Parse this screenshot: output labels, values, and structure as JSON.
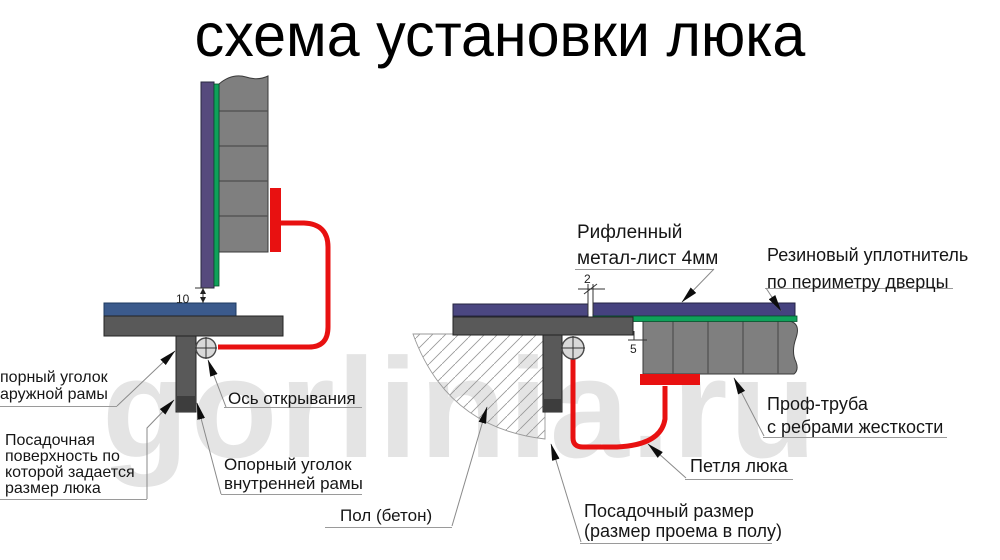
{
  "title": "схема установки люка",
  "watermark": "gorlinia.ru",
  "colors": {
    "hinge_red": "#e81111",
    "sheet_purple_left_view": "#564a7d",
    "sheet_purple_right_view": "#45427f",
    "seal_green": "#0fa15a",
    "tube_gray": "#7f7f7f",
    "frame_gray": "#595959",
    "frame_blue": "#3b5a8c",
    "watermark_gray": "#e4e4e4"
  },
  "left_diagram": {
    "dim_bottom_gap": "10",
    "labels": {
      "outer_frame_angle": {
        "lines": [
          "порный уголок",
          "аружной рамы"
        ]
      },
      "seating_surface": {
        "lines": [
          "Посадочная",
          "поверхность по",
          "которой задается",
          "размер люка"
        ]
      },
      "opening_axis": {
        "text": "Ось открывания"
      },
      "inner_frame_angle": {
        "lines": [
          "Опорный уголок",
          "внутренней рамы"
        ]
      }
    }
  },
  "right_diagram": {
    "dim_sheet_gap": "2",
    "dim_frame_gap": "5",
    "labels": {
      "ribbed_sheet": {
        "lines": [
          "Рифленный",
          "метал-лист 4мм"
        ]
      },
      "rubber_seal": {
        "lines": [
          "Резиновый уплотнитель",
          "по периметру дверцы"
        ]
      },
      "profile_tube": {
        "lines": [
          "Проф-труба",
          "с ребрами жесткости"
        ]
      },
      "hatch_hinge": {
        "text": "Петля люка"
      },
      "concrete_floor": {
        "text": "Пол (бетон)"
      },
      "seating_size": {
        "lines": [
          "Посадочный размер",
          "(размер проема в полу)"
        ]
      }
    }
  }
}
